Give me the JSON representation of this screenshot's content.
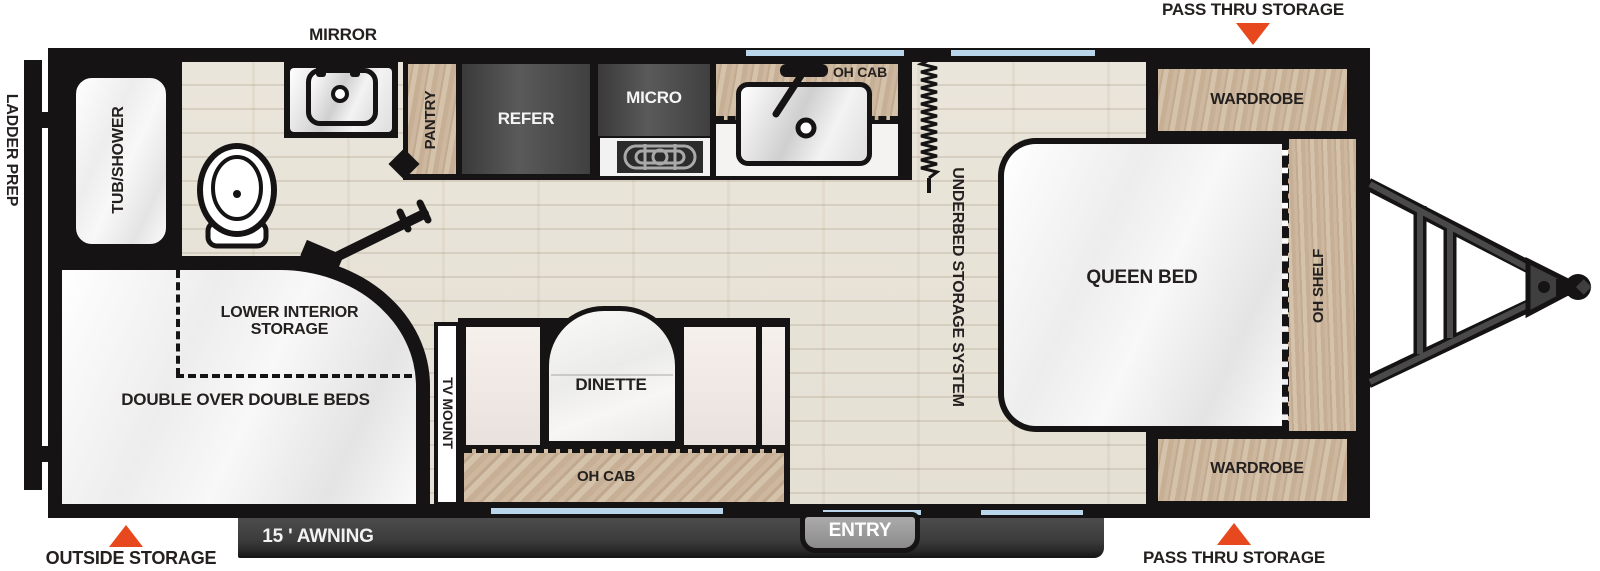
{
  "floorplan": {
    "exterior": {
      "mirror_label": "MIRROR",
      "ladder_prep_label": "LADDER PREP",
      "pass_thru_storage_top_label": "PASS THRU STORAGE",
      "pass_thru_storage_bottom_label": "PASS THRU STORAGE",
      "outside_storage_label": "OUTSIDE STORAGE",
      "awning_label": "15 ' AWNING",
      "entry_label": "ENTRY"
    },
    "bathroom": {
      "tub_shower_label": "TUB/SHOWER"
    },
    "kitchen": {
      "pantry_label": "PANTRY",
      "refrigerator_label": "REFER",
      "microwave_label": "MICRO",
      "overhead_cabinet_label": "OH CAB"
    },
    "bedroom": {
      "queen_bed_label": "QUEEN BED",
      "underbed_storage_label": "UNDERBED STORAGE SYSTEM",
      "wardrobe_top_label": "WARDROBE",
      "wardrobe_bottom_label": "WARDROBE",
      "overhead_shelf_label": "OH SHELF"
    },
    "dinette": {
      "dinette_label": "DINETTE",
      "overhead_cabinet_label": "OH CAB",
      "tv_mount_label": "TV MOUNT"
    },
    "bunk_room": {
      "double_beds_label": "DOUBLE OVER DOUBLE BEDS",
      "lower_interior_storage_label": "LOWER INTERIOR STORAGE"
    },
    "colors": {
      "accent_orange": "#e8481e",
      "window_blue": "#b9d6ea",
      "wood_tan": "#c8b197",
      "floor_beige": "#e9e4d9",
      "wall_black": "#151313",
      "appliance_gray": "#4a4a4a"
    }
  }
}
